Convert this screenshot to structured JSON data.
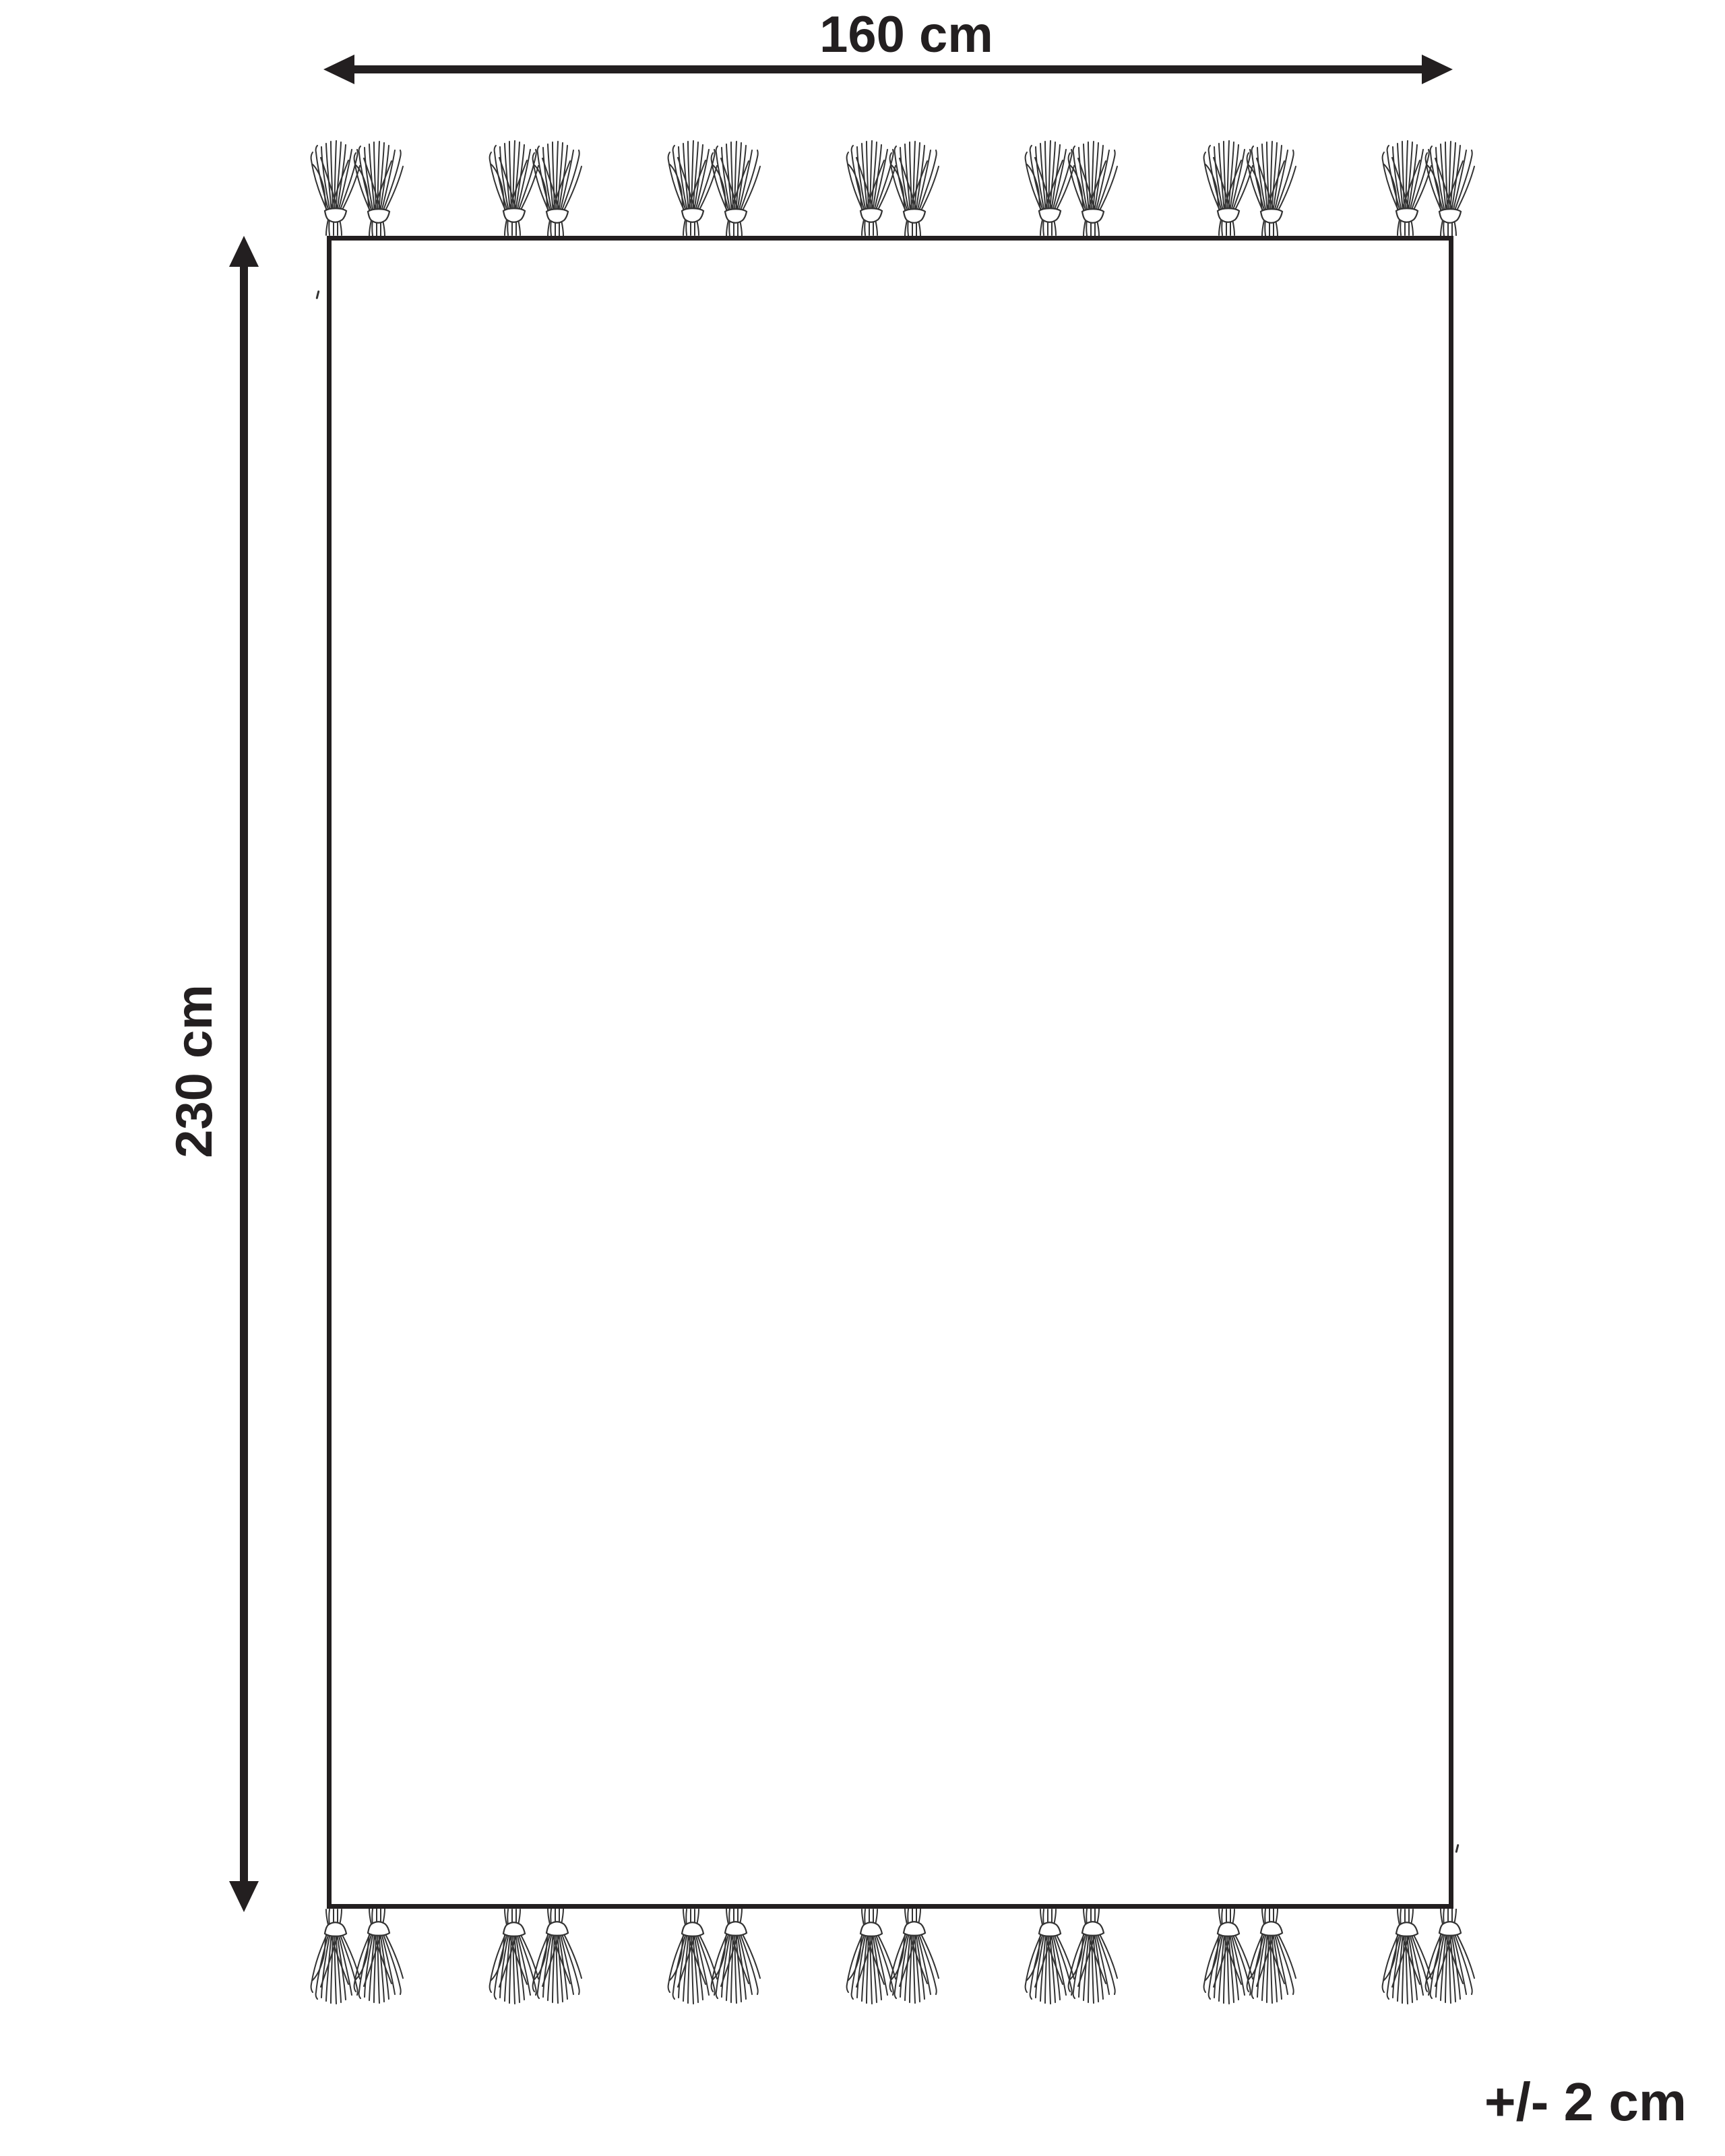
{
  "diagram": {
    "width_label": "160 cm",
    "height_label": "230 cm",
    "tolerance_label": "+/- 2 cm",
    "colors": {
      "ink": "#231f20",
      "strand": "#333333",
      "background": "#ffffff"
    },
    "tassels": {
      "edges": [
        "top",
        "bottom"
      ],
      "groups_per_edge": 7,
      "tassels_per_group": 2
    }
  }
}
